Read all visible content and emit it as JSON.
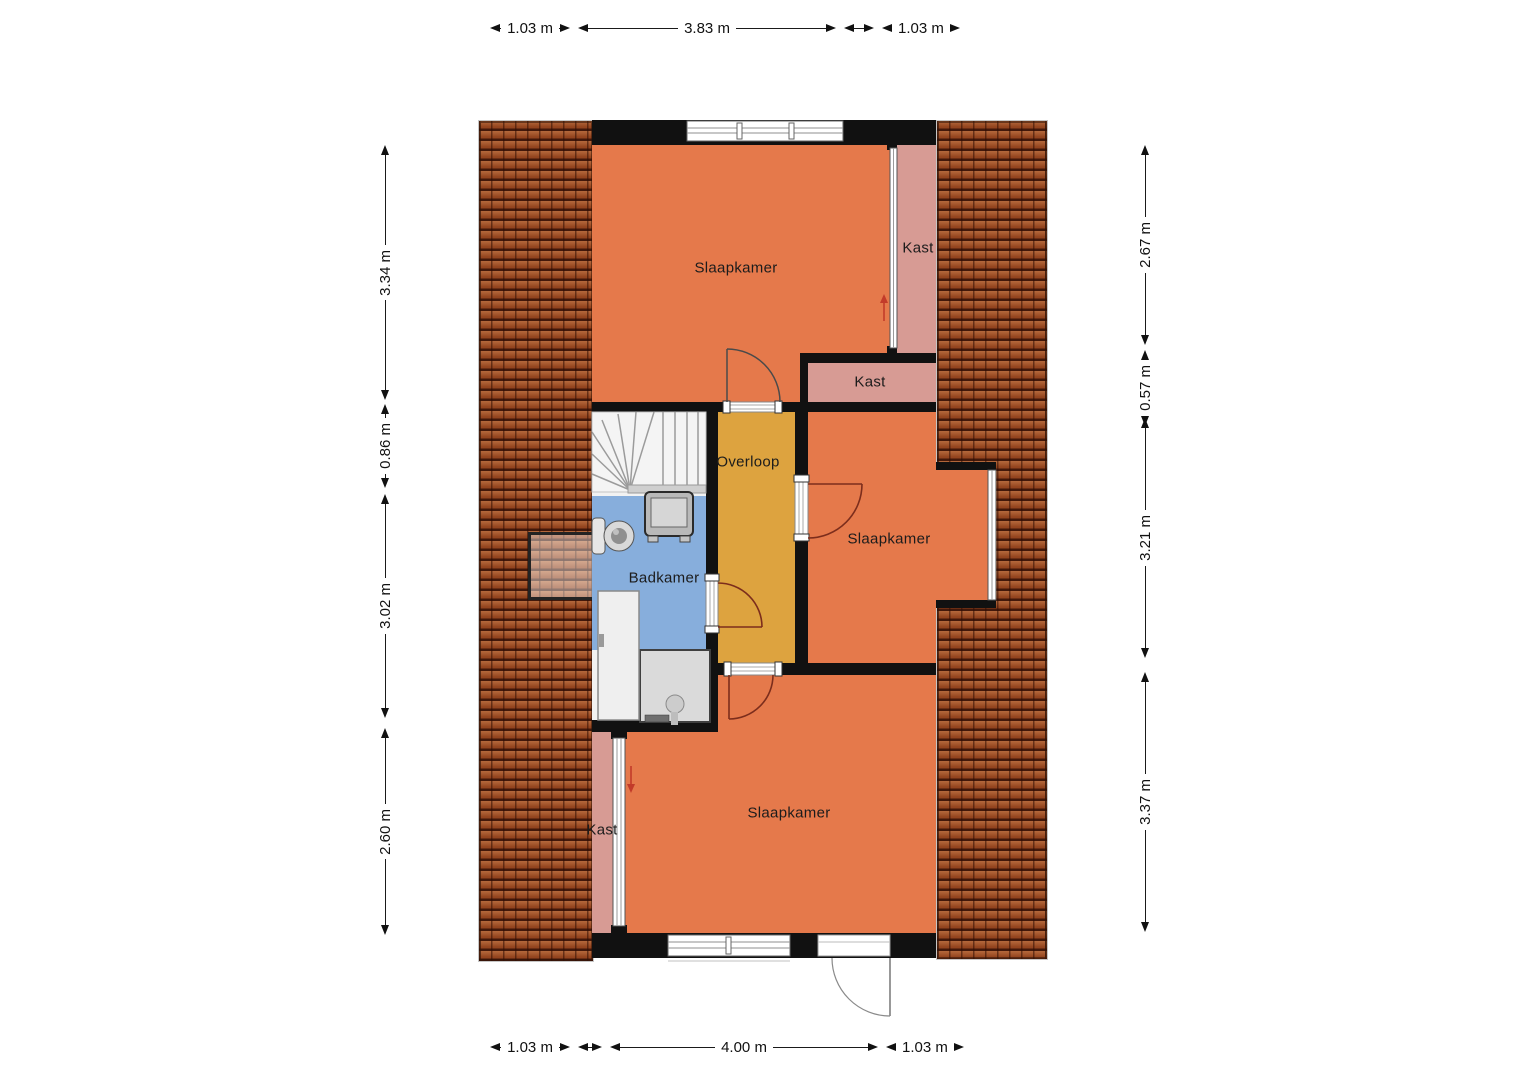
{
  "rooms": [
    {
      "id": "slaapkamer-top",
      "label": "Slaapkamer"
    },
    {
      "id": "kast-right",
      "label": "Kast"
    },
    {
      "id": "kast-middle",
      "label": "Kast"
    },
    {
      "id": "overloop",
      "label": "Overloop"
    },
    {
      "id": "slaapkamer-middle",
      "label": "Slaapkamer"
    },
    {
      "id": "badkamer",
      "label": "Badkamer"
    },
    {
      "id": "kast-bottom",
      "label": "Kast"
    },
    {
      "id": "slaapkamer-bottom",
      "label": "Slaapkamer"
    }
  ],
  "dimensions": {
    "top": [
      "1.03 m",
      "3.83 m",
      "1.03 m"
    ],
    "bottom": [
      "1.03 m",
      "4.00 m",
      "1.03 m"
    ],
    "left": [
      "3.34 m",
      "0.86 m",
      "3.02 m",
      "2.60 m"
    ],
    "right": [
      "2.67 m",
      "0.57 m",
      "3.21 m",
      "3.37 m"
    ]
  },
  "colors": {
    "bedroom_orange": "#e5794b",
    "closet_pink": "#d79b94",
    "landing_amber": "#dda33f",
    "bathroom_blue": "#87aedc",
    "roof_tile": "#9a4e2b",
    "wall_black": "#111111",
    "door_arc_maroon": "#7c2d1c",
    "stair_arrow_red": "#c23b2a"
  }
}
